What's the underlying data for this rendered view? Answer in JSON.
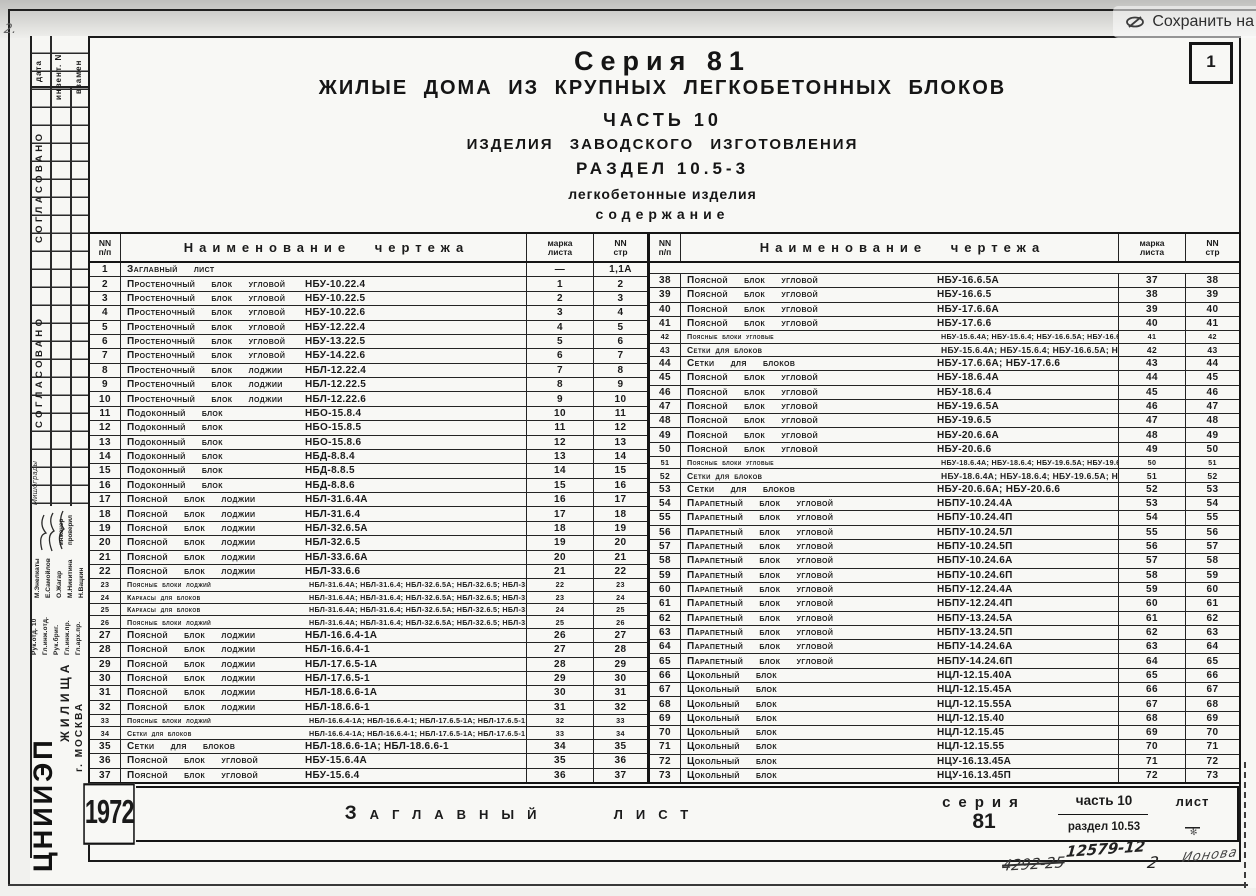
{
  "overlay": {
    "save_label": "Сохранить на",
    "icon": "yandex-disk-icon"
  },
  "page_number": "1",
  "corner_mark": "2.",
  "header": {
    "line1": "Серия 81",
    "line2": "ЖИЛЫЕ ДОМА ИЗ КРУПНЫХ ЛЕГКОБЕТОННЫХ БЛОКОВ",
    "line3": "ЧАСТЬ 10",
    "line4": "ИЗДЕЛИЯ ЗАВОДСКОГО ИЗГОТОВЛЕНИЯ",
    "line5": "РАЗДЕЛ 10.5-3",
    "line6": "легкобетонные изделия",
    "line7": "содержание"
  },
  "table_headers": {
    "num_top": "NN",
    "num_bottom": "п/п",
    "name": "Наименование чертежа",
    "mark_top": "марка",
    "mark_bottom": "листа",
    "page_top": "NN",
    "page_bottom": "стр"
  },
  "contents": {
    "left": [
      {
        "n": "1",
        "name": "Заглавный лист",
        "code": "",
        "mark": "—",
        "pg": "1,1А"
      },
      {
        "n": "2",
        "name": "Простеночный блок угловой",
        "code": "НБУ-10.22.4",
        "mark": "1",
        "pg": "2"
      },
      {
        "n": "3",
        "name": "Простеночный блок угловой",
        "code": "НБУ-10.22.5",
        "mark": "2",
        "pg": "3"
      },
      {
        "n": "4",
        "name": "Простеночный блок угловой",
        "code": "НБУ-10.22.6",
        "mark": "3",
        "pg": "4"
      },
      {
        "n": "5",
        "name": "Простеночный блок угловой",
        "code": "НБУ-12.22.4",
        "mark": "4",
        "pg": "5"
      },
      {
        "n": "6",
        "name": "Простеночный блок угловой",
        "code": "НБУ-13.22.5",
        "mark": "5",
        "pg": "6"
      },
      {
        "n": "7",
        "name": "Простеночный блок угловой",
        "code": "НБУ-14.22.6",
        "mark": "6",
        "pg": "7"
      },
      {
        "n": "8",
        "name": "Простеночный блок лоджии",
        "code": "НБЛ-12.22.4",
        "mark": "7",
        "pg": "8"
      },
      {
        "n": "9",
        "name": "Простеночный блок лоджии",
        "code": "НБЛ-12.22.5",
        "mark": "8",
        "pg": "9"
      },
      {
        "n": "10",
        "name": "Простеночный блок лоджии",
        "code": "НБЛ-12.22.6",
        "mark": "9",
        "pg": "10"
      },
      {
        "n": "11",
        "name": "Подоконный блок",
        "code": "НБО-15.8.4",
        "mark": "10",
        "pg": "11"
      },
      {
        "n": "12",
        "name": "Подоконный блок",
        "code": "НБО-15.8.5",
        "mark": "11",
        "pg": "12"
      },
      {
        "n": "13",
        "name": "Подоконный блок",
        "code": "НБО-15.8.6",
        "mark": "12",
        "pg": "13"
      },
      {
        "n": "14",
        "name": "Подоконный блок",
        "code": "НБД-8.8.4",
        "mark": "13",
        "pg": "14"
      },
      {
        "n": "15",
        "name": "Подоконный блок",
        "code": "НБД-8.8.5",
        "mark": "14",
        "pg": "15"
      },
      {
        "n": "16",
        "name": "Подоконный блок",
        "code": "НБД-8.8.6",
        "mark": "15",
        "pg": "16"
      },
      {
        "n": "17",
        "name": "Поясной блок лоджии",
        "code": "НБЛ-31.6.4А",
        "mark": "16",
        "pg": "17"
      },
      {
        "n": "18",
        "name": "Поясной блок лоджии",
        "code": "НБЛ-31.6.4",
        "mark": "17",
        "pg": "18"
      },
      {
        "n": "19",
        "name": "Поясной блок лоджии",
        "code": "НБЛ-32.6.5А",
        "mark": "18",
        "pg": "19"
      },
      {
        "n": "20",
        "name": "Поясной блок лоджии",
        "code": "НБЛ-32.6.5",
        "mark": "19",
        "pg": "20"
      },
      {
        "n": "21",
        "name": "Поясной блок лоджии",
        "code": "НБЛ-33.6.6А",
        "mark": "20",
        "pg": "21"
      },
      {
        "n": "22",
        "name": "Поясной блок лоджии",
        "code": "НБЛ-33.6.6",
        "mark": "21",
        "pg": "22"
      },
      {
        "n": "23",
        "name": "Поясные блоки лоджий",
        "code": "НБЛ-31.6.4А; НБЛ-31.6.4; НБЛ-32.6.5А; НБЛ-32.6.5; НБЛ-33.6.6А; НБЛ-33.6.6",
        "mark": "22",
        "pg": "23"
      },
      {
        "n": "24",
        "name": "Каркасы для блоков",
        "code": "НБЛ-31.6.4А; НБЛ-31.6.4; НБЛ-32.6.5А; НБЛ-32.6.5; НБЛ-33.6.6А; НБЛ-33.6.6",
        "mark": "23",
        "pg": "24"
      },
      {
        "n": "25",
        "name": "Каркасы для блоков",
        "code": "НБЛ-31.6.4А; НБЛ-31.6.4; НБЛ-32.6.5А; НБЛ-32.6.5; НБЛ-33.6.6А; НБЛ-33.6.6",
        "mark": "24",
        "pg": "25"
      },
      {
        "n": "26",
        "name": "Поясные блоки лоджий",
        "code": "НБЛ-31.6.4А; НБЛ-31.6.4; НБЛ-32.6.5А; НБЛ-32.6.5; НБЛ-33.6.6А; НБЛ-33.6.6",
        "mark": "25",
        "pg": "26"
      },
      {
        "n": "27",
        "name": "Поясной блок лоджии",
        "code": "НБЛ-16.6.4-1А",
        "mark": "26",
        "pg": "27"
      },
      {
        "n": "28",
        "name": "Поясной блок лоджии",
        "code": "НБЛ-16.6.4-1",
        "mark": "27",
        "pg": "28"
      },
      {
        "n": "29",
        "name": "Поясной блок лоджии",
        "code": "НБЛ-17.6.5-1А",
        "mark": "28",
        "pg": "29"
      },
      {
        "n": "30",
        "name": "Поясной блок лоджии",
        "code": "НБЛ-17.6.5-1",
        "mark": "29",
        "pg": "30"
      },
      {
        "n": "31",
        "name": "Поясной блок лоджии",
        "code": "НБЛ-18.6.6-1А",
        "mark": "30",
        "pg": "31"
      },
      {
        "n": "32",
        "name": "Поясной блок лоджии",
        "code": "НБЛ-18.6.6-1",
        "mark": "31",
        "pg": "32"
      },
      {
        "n": "33",
        "name": "Поясные блоки лоджий",
        "code": "НБЛ-16.6.4-1А; НБЛ-16.6.4-1; НБЛ-17.6.5-1А; НБЛ-17.6.5-1; НБЛ-18.6.6-1А; НБЛ-18.6.6-1",
        "mark": "32",
        "pg": "33"
      },
      {
        "n": "34",
        "name": "Сетки для блоков",
        "code": "НБЛ-16.6.4-1А; НБЛ-16.6.4-1; НБЛ-17.6.5-1А; НБЛ-17.6.5-1",
        "mark": "33",
        "pg": "34"
      },
      {
        "n": "35",
        "name": "Сетки для блоков",
        "code": "НБЛ-18.6.6-1А; НБЛ-18.6.6-1",
        "mark": "34",
        "pg": "35"
      },
      {
        "n": "36",
        "name": "Поясной блок угловой",
        "code": "НБУ-15.6.4А",
        "mark": "35",
        "pg": "36"
      },
      {
        "n": "37",
        "name": "Поясной блок угловой",
        "code": "НБУ-15.6.4",
        "mark": "36",
        "pg": "37"
      }
    ],
    "right": [
      {
        "n": "38",
        "name": "Поясной блок угловой",
        "code": "НБУ-16.6.5А",
        "mark": "37",
        "pg": "38"
      },
      {
        "n": "39",
        "name": "Поясной блок угловой",
        "code": "НБУ-16.6.5",
        "mark": "38",
        "pg": "39"
      },
      {
        "n": "40",
        "name": "Поясной блок угловой",
        "code": "НБУ-17.6.6А",
        "mark": "39",
        "pg": "40"
      },
      {
        "n": "41",
        "name": "Поясной блок угловой",
        "code": "НБУ-17.6.6",
        "mark": "40",
        "pg": "41"
      },
      {
        "n": "42",
        "name": "Поясные блоки угловые",
        "code": "НБУ-15.6.4А; НБУ-15.6.4; НБУ-16.6.5А; НБУ-16.6.5; НБУ-17.6.6А; НБУ-17.6.6",
        "mark": "41",
        "pg": "42"
      },
      {
        "n": "43",
        "name": "Сетки для блоков",
        "code": "НБУ-15.6.4А; НБУ-15.6.4; НБУ-16.6.5А; НБУ-16.6.5",
        "mark": "42",
        "pg": "43"
      },
      {
        "n": "44",
        "name": "Сетки для блоков",
        "code": "НБУ-17.6.6А; НБУ-17.6.6",
        "mark": "43",
        "pg": "44"
      },
      {
        "n": "45",
        "name": "Поясной блок угловой",
        "code": "НБУ-18.6.4А",
        "mark": "44",
        "pg": "45"
      },
      {
        "n": "46",
        "name": "Поясной блок угловой",
        "code": "НБУ-18.6.4",
        "mark": "45",
        "pg": "46"
      },
      {
        "n": "47",
        "name": "Поясной блок угловой",
        "code": "НБУ-19.6.5А",
        "mark": "46",
        "pg": "47"
      },
      {
        "n": "48",
        "name": "Поясной блок угловой",
        "code": "НБУ-19.6.5",
        "mark": "47",
        "pg": "48"
      },
      {
        "n": "49",
        "name": "Поясной блок угловой",
        "code": "НБУ-20.6.6А",
        "mark": "48",
        "pg": "49"
      },
      {
        "n": "50",
        "name": "Поясной блок угловой",
        "code": "НБУ-20.6.6",
        "mark": "49",
        "pg": "50"
      },
      {
        "n": "51",
        "name": "Поясные блоки угловые",
        "code": "НБУ-18.6.4А; НБУ-18.6.4; НБУ-19.6.5А; НБУ-19.6.5; НБУ-20.6.6А; НБУ-20.6.6",
        "mark": "50",
        "pg": "51"
      },
      {
        "n": "52",
        "name": "Сетки для блоков",
        "code": "НБУ-18.6.4А; НБУ-18.6.4; НБУ-19.6.5А; НБУ-19.6.5",
        "mark": "51",
        "pg": "52"
      },
      {
        "n": "53",
        "name": "Сетки для блоков",
        "code": "НБУ-20.6.6А; НБУ-20.6.6",
        "mark": "52",
        "pg": "53"
      },
      {
        "n": "54",
        "name": "Парапетный блок угловой",
        "code": "НБПУ-10.24.4А",
        "mark": "53",
        "pg": "54"
      },
      {
        "n": "55",
        "name": "Парапетный блок угловой",
        "code": "НБПУ-10.24.4П",
        "mark": "54",
        "pg": "55"
      },
      {
        "n": "56",
        "name": "Парапетный блок угловой",
        "code": "НБПУ-10.24.5Л",
        "mark": "55",
        "pg": "56"
      },
      {
        "n": "57",
        "name": "Парапетный блок угловой",
        "code": "НБПУ-10.24.5П",
        "mark": "56",
        "pg": "57"
      },
      {
        "n": "58",
        "name": "Парапетный блок угловой",
        "code": "НБПУ-10.24.6А",
        "mark": "57",
        "pg": "58"
      },
      {
        "n": "59",
        "name": "Парапетный блок угловой",
        "code": "НБПУ-10.24.6П",
        "mark": "58",
        "pg": "59"
      },
      {
        "n": "60",
        "name": "Парапетный блок угловой",
        "code": "НБПУ-12.24.4А",
        "mark": "59",
        "pg": "60"
      },
      {
        "n": "61",
        "name": "Парапетный блок угловой",
        "code": "НБПУ-12.24.4П",
        "mark": "60",
        "pg": "61"
      },
      {
        "n": "62",
        "name": "Парапетный блок угловой",
        "code": "НБПУ-13.24.5А",
        "mark": "61",
        "pg": "62"
      },
      {
        "n": "63",
        "name": "Парапетный блок угловой",
        "code": "НБПУ-13.24.5П",
        "mark": "62",
        "pg": "63"
      },
      {
        "n": "64",
        "name": "Парапетный блок угловой",
        "code": "НБПУ-14.24.6А",
        "mark": "63",
        "pg": "64"
      },
      {
        "n": "65",
        "name": "Парапетный блок угловой",
        "code": "НБПУ-14.24.6П",
        "mark": "64",
        "pg": "65"
      },
      {
        "n": "66",
        "name": "Цокольный блок",
        "code": "НЦЛ-12.15.40А",
        "mark": "65",
        "pg": "66"
      },
      {
        "n": "67",
        "name": "Цокольный блок",
        "code": "НЦЛ-12.15.45А",
        "mark": "66",
        "pg": "67"
      },
      {
        "n": "68",
        "name": "Цокольный блок",
        "code": "НЦЛ-12.15.55А",
        "mark": "67",
        "pg": "68"
      },
      {
        "n": "69",
        "name": "Цокольный блок",
        "code": "НЦЛ-12.15.40",
        "mark": "68",
        "pg": "69"
      },
      {
        "n": "70",
        "name": "Цокольный блок",
        "code": "НЦЛ-12.15.45",
        "mark": "69",
        "pg": "70"
      },
      {
        "n": "71",
        "name": "Цокольный блок",
        "code": "НЦЛ-12.15.55",
        "mark": "70",
        "pg": "71"
      },
      {
        "n": "72",
        "name": "Цокольный блок",
        "code": "НЦУ-16.13.45А",
        "mark": "71",
        "pg": "72"
      },
      {
        "n": "73",
        "name": "Цокольный блок",
        "code": "НЦУ-16.13.45П",
        "mark": "72",
        "pg": "73"
      }
    ]
  },
  "footer": {
    "year": "1972",
    "title": "Заглавный лист"
  },
  "title_block": {
    "series_label": "серия",
    "series_value": "81",
    "part": "часть 10",
    "section": "раздел 10.53",
    "sheet_label": "лист",
    "sheet_value": "—"
  },
  "handwriting": {
    "number": "12579-12",
    "crossed_number": "4292-25",
    "sheet_count": "2",
    "signature": "Ионова"
  },
  "sidebar": {
    "top_cells": [
      "дата",
      "инвент. N",
      "взамен"
    ],
    "agreed1": "СОГЛАСОВАНО",
    "agreed2": "СОГЛАСОВАНО",
    "note": "Мишограды",
    "labels": [
      "инженер",
      "проверил"
    ],
    "roles": [
      "Рук.отд. 10",
      "Гл.инж.отд.",
      "Рук.бриг.",
      "Гл.инж.пр.",
      "Гл.арх.пр."
    ],
    "names": [
      "М.Энелкаты",
      "Е.Самойлов",
      "О.Жагар",
      "М.Никитина",
      "Н.Вацкин"
    ],
    "org_logo": "ЦНИИЭП",
    "org_line1": "ЖИЛИЩА",
    "org_line2": "г. МОСКВА"
  }
}
